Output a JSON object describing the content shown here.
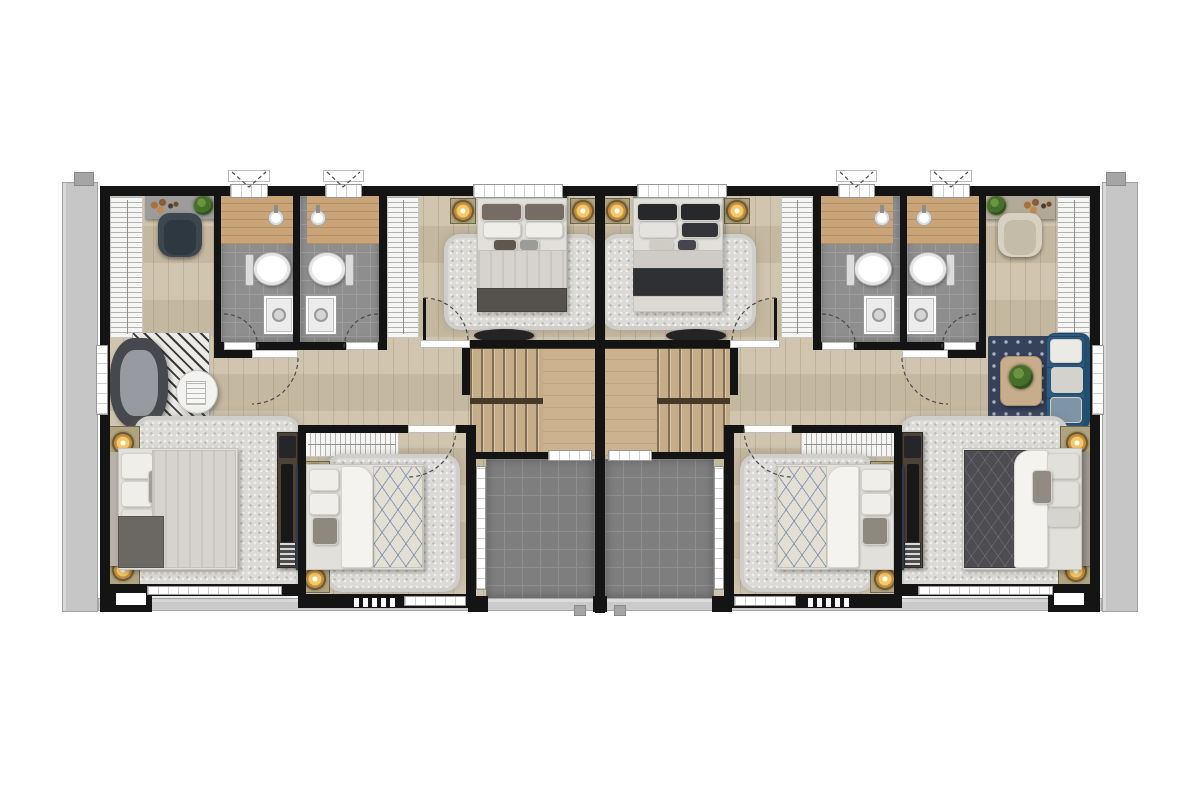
{
  "document": {
    "kind": "architectural floor plan",
    "view": "top-down rendered plan",
    "layout": "two mirrored dwelling units (duplex), upper floor",
    "visible_text_labels": []
  },
  "palette": {
    "background": "#ffffff",
    "wall": "#141414",
    "wood_floor": "#cdc1a9",
    "bathroom_tile": "#8e8e8e",
    "terrace_tile": "#7e7e7e",
    "vanity_counter_wood": "#c9a478",
    "stair_wood": "#c6ad89",
    "concrete_ledge": "#c6c6c6",
    "window_frame": "#ffffff",
    "lamp_glow": "#f5c96a",
    "sofa_blue": "#2c5a80",
    "rug_navy": "#36415a",
    "dark_bedding": "#4d4d51",
    "light_bedding": "#d6d3ce",
    "navy_headboard": "#303c4e"
  },
  "units": [
    {
      "side": "left",
      "rooms": [
        {
          "name": "master-bedroom",
          "furniture": [
            "wardrobe",
            "desk",
            "desk-chair",
            "plant",
            "lounge-chair",
            "chevron-rug",
            "side-table",
            "book",
            "double-bed-light",
            "bedside-lamp",
            "bedside-lamp",
            "shag-rug",
            "tv-cabinet"
          ]
        },
        {
          "name": "bathroom-1",
          "furniture": [
            "vanity-counter",
            "sink-basin",
            "toilet",
            "shower-tray"
          ]
        },
        {
          "name": "bathroom-2",
          "furniture": [
            "vanity-counter",
            "sink-basin",
            "toilet",
            "shower-tray"
          ]
        },
        {
          "name": "bedroom-2-front",
          "furniture": [
            "wardrobe",
            "double-bed-light",
            "bedside-lamp",
            "bedside-lamp",
            "shag-rug",
            "tv-console"
          ]
        },
        {
          "name": "bedroom-3-rear",
          "furniture": [
            "wardrobe",
            "double-bed-blue-grid",
            "bedside-lamp",
            "bedside-lamp",
            "shag-rug"
          ]
        },
        {
          "name": "staircase",
          "furniture": [
            "upper-flight",
            "landing",
            "lower-flight"
          ]
        },
        {
          "name": "terrace",
          "furniture": []
        }
      ]
    },
    {
      "side": "right",
      "rooms": [
        {
          "name": "master-bedroom",
          "furniture": [
            "wardrobe",
            "desk",
            "desk-chair",
            "plant",
            "blue-sofa",
            "navy-trellis-rug",
            "coffee-table",
            "plant",
            "double-bed-dark",
            "bedside-lamp",
            "bedside-lamp",
            "shag-rug",
            "tv-cabinet"
          ]
        },
        {
          "name": "bathroom-3",
          "furniture": [
            "vanity-counter",
            "sink-basin",
            "toilet",
            "shower-tray"
          ]
        },
        {
          "name": "bathroom-4",
          "furniture": [
            "vanity-counter",
            "sink-basin",
            "toilet",
            "shower-tray"
          ]
        },
        {
          "name": "bedroom-2-front",
          "furniture": [
            "wardrobe",
            "double-bed-dark-accent",
            "bedside-lamp",
            "bedside-lamp",
            "shag-rug",
            "tv-console"
          ]
        },
        {
          "name": "bedroom-3-rear",
          "furniture": [
            "wardrobe",
            "double-bed-blue-grid",
            "bedside-lamp",
            "bedside-lamp",
            "shag-rug"
          ]
        },
        {
          "name": "staircase",
          "furniture": [
            "upper-flight",
            "landing",
            "lower-flight"
          ]
        },
        {
          "name": "terrace",
          "furniture": []
        }
      ]
    }
  ],
  "symbols": [
    "door-swing-arc",
    "awning-window-symbol",
    "window-with-mullions",
    "vent-hatch",
    "downspout"
  ]
}
